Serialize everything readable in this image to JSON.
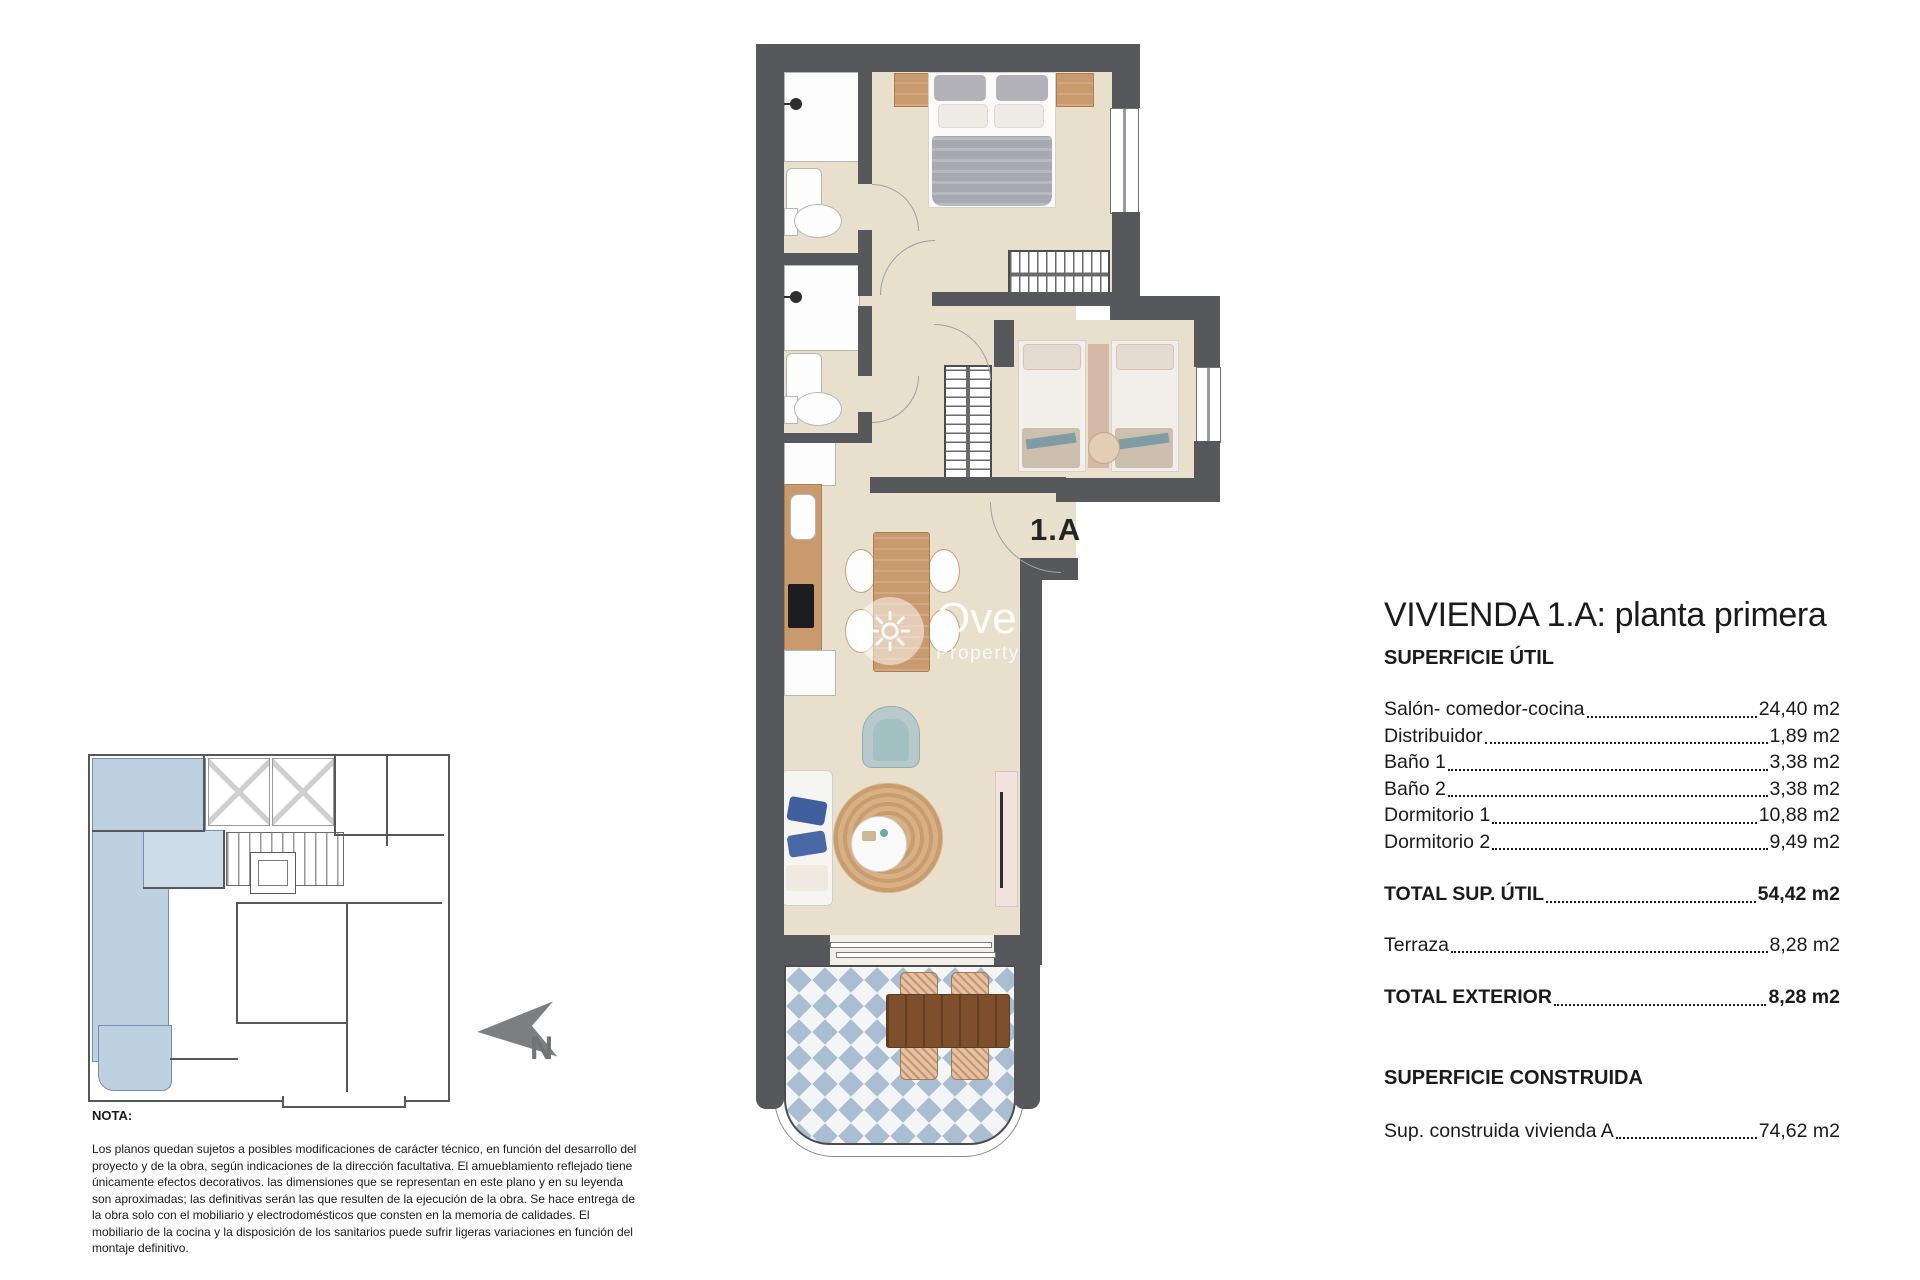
{
  "plan": {
    "unit_label": "1.A",
    "watermark": {
      "name": "Overseas",
      "tagline": "Property Market"
    }
  },
  "north": {
    "label": "N"
  },
  "panel": {
    "title": "VIVIENDA 1.A: planta primera",
    "section1_heading": "SUPERFICIE ÚTIL",
    "rooms": [
      {
        "label": "Salón- comedor-cocina",
        "value": "24,40 m2"
      },
      {
        "label": "Distribuidor",
        "value": "1,89 m2"
      },
      {
        "label": "Baño 1",
        "value": "3,38 m2"
      },
      {
        "label": "Baño 2",
        "value": "3,38 m2"
      },
      {
        "label": "Dormitorio 1",
        "value": "10,88 m2"
      },
      {
        "label": "Dormitorio 2",
        "value": "9,49 m2"
      }
    ],
    "total_util": {
      "label": "TOTAL SUP. ÚTIL",
      "value": "54,42 m2"
    },
    "terraza": {
      "label": "Terraza",
      "value": "8,28 m2"
    },
    "total_exterior": {
      "label": "TOTAL EXTERIOR",
      "value": "8,28 m2"
    },
    "section2_heading": "SUPERFICIE CONSTRUIDA",
    "constructed": {
      "label": "Sup. construida vivienda A",
      "value": "74,62 m2"
    }
  },
  "note": {
    "heading": "NOTA:",
    "body": "Los planos quedan sujetos a posibles modificaciones de carácter técnico, en función del desarrollo del proyecto y de la obra, según indicaciones de la dirección facultativa. El amueblamiento reflejado tiene únicamente efectos decorativos. las dimensiones que se representan en este plano y en su leyenda son aproximadas; las definitivas serán las que resulten de la ejecución de la obra. Se hace entrega de la obra solo con el mobiliario y electrodomésticos que consten en la memoria de calidades. El mobiliario de la cocina y la disposición de los sanitarios puede sufrir ligeras variaciones en función del montaje definitivo."
  },
  "colors": {
    "wall": "#57585b",
    "floor_beige": "#e8e0cd",
    "terrace_tile_blue": "#a9bed2",
    "wood": "#c99a6e",
    "terrace_wood": "#7d4f2c",
    "highlight_unit_blue": "#bdd1e1",
    "armchair_teal": "#a3c0c3",
    "rug_jute": "#d0a87b",
    "north_arrow_gray": "#7c7e80"
  }
}
